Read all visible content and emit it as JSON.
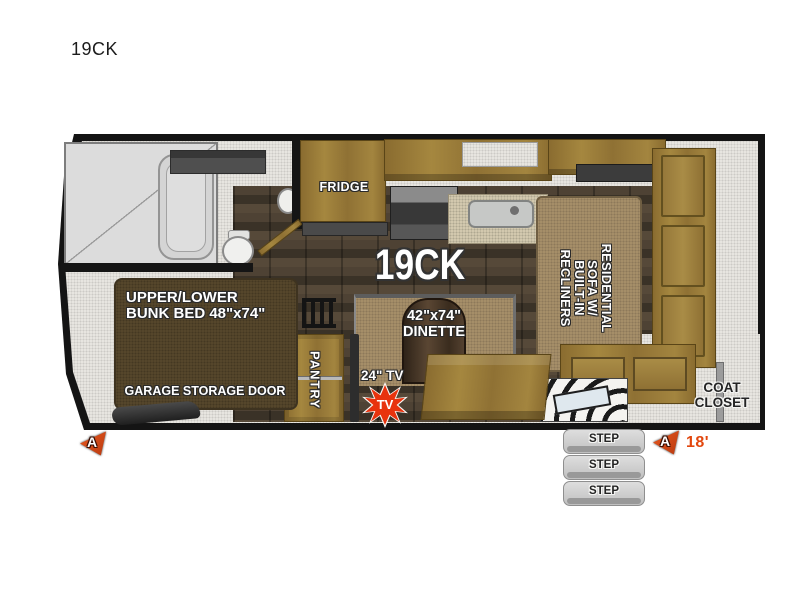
{
  "page": {
    "title": "19CK"
  },
  "floorplan": {
    "model_label": "19CK",
    "labels": {
      "fridge": "FRIDGE",
      "bunk_line1": "UPPER/LOWER",
      "bunk_line2": "BUNK BED 48\"x74\"",
      "garage_door": "GARAGE STORAGE DOOR",
      "pantry": "PANTRY",
      "tv": "24\" TV",
      "tv_badge": "TV",
      "dinette_line1": "42\"x74\"",
      "dinette_line2": "DINETTE",
      "sofa_line1": "RESIDENTIAL",
      "sofa_line2": "SOFA W/",
      "sofa_line3": "BUILT-IN",
      "sofa_line4": "RECLINERS",
      "coat_line1": "COAT",
      "coat_line2": "CLOSET"
    },
    "steps": [
      "STEP",
      "STEP",
      "STEP"
    ],
    "markers": {
      "left_letter": "A",
      "right_letter": "A",
      "length": "18'"
    },
    "colors": {
      "tv_badge_red": "#e8330e",
      "marker_orange": "#d5491b",
      "length_text": "#e2470e",
      "wood": "#96783c",
      "bunk_brown": "#57482c",
      "dark_floor": "#473c30",
      "floor_speckle": "#eae8e3"
    }
  }
}
